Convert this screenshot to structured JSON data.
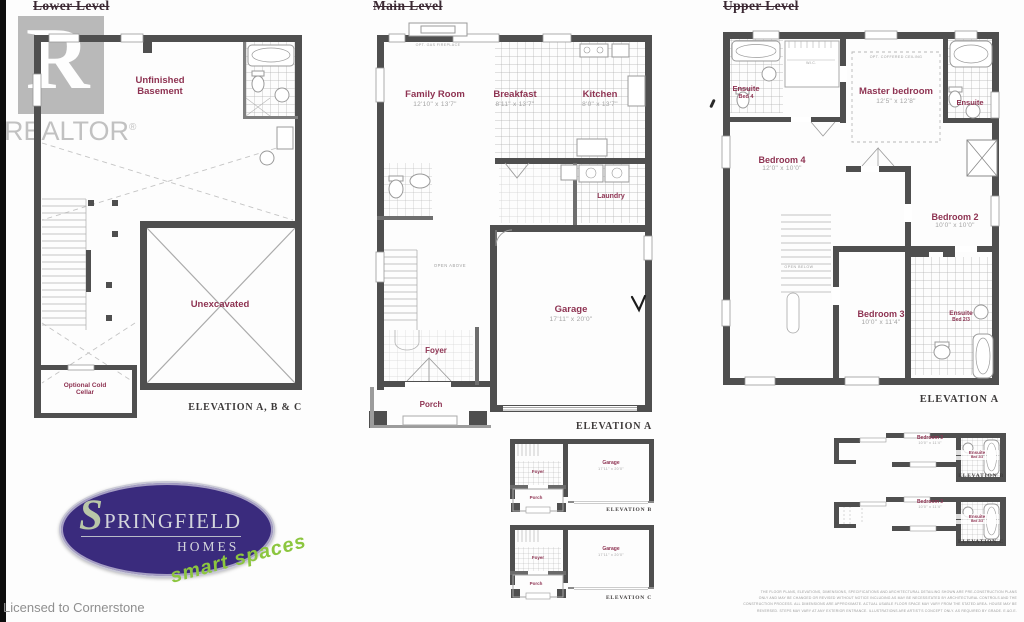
{
  "colors": {
    "wall": "#4f4f4f",
    "room_label": "#8e3352",
    "logo_purple": "#3a2b7d",
    "logo_green": "#8cc63f"
  },
  "branding": {
    "realtor": "REALTOR",
    "reg": "®",
    "licensed": "Licensed to Cornerstone"
  },
  "logo": {
    "s": "S",
    "name_rest": "PRINGFIELD",
    "homes": "HOMES",
    "tagline": "smart spaces"
  },
  "lower": {
    "title": "Lower Level",
    "room1": "Unfinished Basement",
    "room2": "Unexcavated",
    "cold_cellar": "Optional Cold Cellar",
    "elevation": "ELEVATION A, B & C"
  },
  "main": {
    "title": "Main Level",
    "family": {
      "name": "Family Room",
      "dims": "12'10\" x 13'7\""
    },
    "breakfast": {
      "name": "Breakfast",
      "dims": "8'11\" x 13'7\""
    },
    "kitchen": {
      "name": "Kitchen",
      "dims": "8'0\" x 13'7\""
    },
    "laundry": "Laundry",
    "garage": {
      "name": "Garage",
      "dims": "17'11\" x 20'0\""
    },
    "foyer": "Foyer",
    "porch": "Porch",
    "open_above": "OPEN ABOVE",
    "fireplace_note": "OPT. GAS FIREPLACE",
    "elevation": "ELEVATION A"
  },
  "upper": {
    "title": "Upper Level",
    "ensuite4": {
      "name": "Ensuite",
      "sub": "Bed 4"
    },
    "wic": "W.I.C.",
    "coffered": "OPT. COFFERED CEILING",
    "master": {
      "name": "Master bedroom",
      "dims": "12'5\" x 12'8\""
    },
    "ensuite": {
      "name": "Ensuite"
    },
    "bedroom4": {
      "name": "Bedroom 4",
      "dims": "12'0\" x 10'0\""
    },
    "bedroom2": {
      "name": "Bedroom 2",
      "dims": "10'0\" x 10'0\""
    },
    "bedroom3": {
      "name": "Bedroom 3",
      "dims": "10'0\" x 11'4\""
    },
    "ensuite23": {
      "name": "Ensuite",
      "sub": "Bed 2/3"
    },
    "open_below": "OPEN BELOW",
    "elevation": "ELEVATION A"
  },
  "variants": {
    "mid_b": {
      "foyer": "Foyer",
      "porch": "Porch",
      "garage": "Garage",
      "garage_dims": "17'11\" x 20'0\"",
      "elevation": "ELEVATION B"
    },
    "mid_c": {
      "foyer": "Foyer",
      "porch": "Porch",
      "garage": "Garage",
      "garage_dims": "17'11\" x 20'0\"",
      "elevation": "ELEVATION C"
    },
    "right_b": {
      "bedroom": {
        "name": "Bedroom 3",
        "dims": "10'0\" x 11'4\""
      },
      "ensuite": {
        "name": "Ensuite",
        "sub": "Bed 2/3"
      },
      "elevation": "ELEVATION B"
    },
    "right_c": {
      "bedroom": {
        "name": "Bedroom 3",
        "dims": "10'0\" x 11'4\""
      },
      "ensuite": {
        "name": "Ensuite",
        "sub": "Bed 2/3"
      },
      "elevation": "ELEVATION C"
    }
  },
  "disclaimer": {
    "l1": "THE FLOOR PLANS, ELEVATIONS, DIMENSIONS, SPECIFICATIONS AND ARCHITECTURAL DETAILING SHOWN ARE PRE-CONSTRUCTION PLANS",
    "l2": "ONLY AND MAY BE CHANGED OR REVISED WITHOUT NOTICE INCLUDING AS MAY BE NECESSITATED BY ARCHITECTURAL CONTROLS AND THE",
    "l3": "CONSTRUCTION PROCESS. ALL DIMENSIONS ARE APPROXIMATE. ACTUAL USABLE FLOOR SPACE MAY VARY FROM THE STATED AREA. HOUSE MAY BE",
    "l4": "REVERSED. STEPS MAY VARY AT ANY EXTERIOR ENTRANCE. ILLUSTRATIONS ARE ARTIST'S CONCEPT ONLY. AS REQUIRED BY GRADE. E.&O.E."
  }
}
